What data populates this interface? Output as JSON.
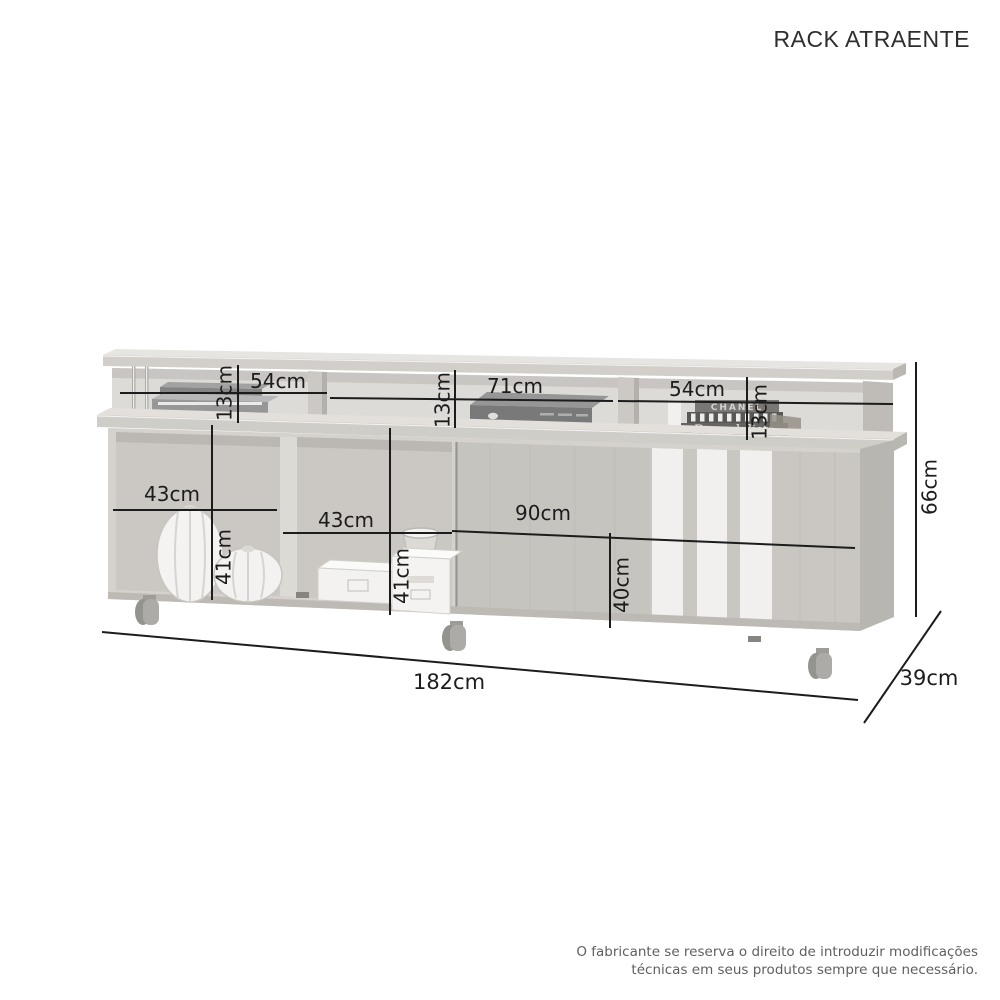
{
  "page": {
    "title": "RACK ATRAENTE",
    "disclaimer_line1": "O fabricante se reserva o direito de introduzir modificações",
    "disclaimer_line2": "técnicas em seus produtos sempre que necessário."
  },
  "dimensions": {
    "top_niche_left_height": "13cm",
    "top_niche_left_width": "54cm",
    "top_niche_center_height": "13cm",
    "top_niche_center_width": "71cm",
    "top_niche_right_width": "54cm",
    "top_niche_right_height": "13cm",
    "total_height": "66cm",
    "lower_niche_left_width": "43cm",
    "lower_niche_left_height": "41cm",
    "lower_niche_center_width": "43cm",
    "lower_niche_center_height": "41cm",
    "door_section_width": "90cm",
    "door_section_height": "40cm",
    "total_width": "182cm",
    "total_depth": "39cm"
  },
  "decor": {
    "book_top_label": "CHANEL",
    "book_bottom_label": "Remodelista"
  },
  "colors": {
    "dimension_line": "#1c1c1c",
    "title_text": "#2e2e2e",
    "disclaimer_text": "#5f5f5f",
    "wood_light": "#d2cfca",
    "wood_side": "#b3b0ab",
    "panel_white": "#f0efed"
  }
}
